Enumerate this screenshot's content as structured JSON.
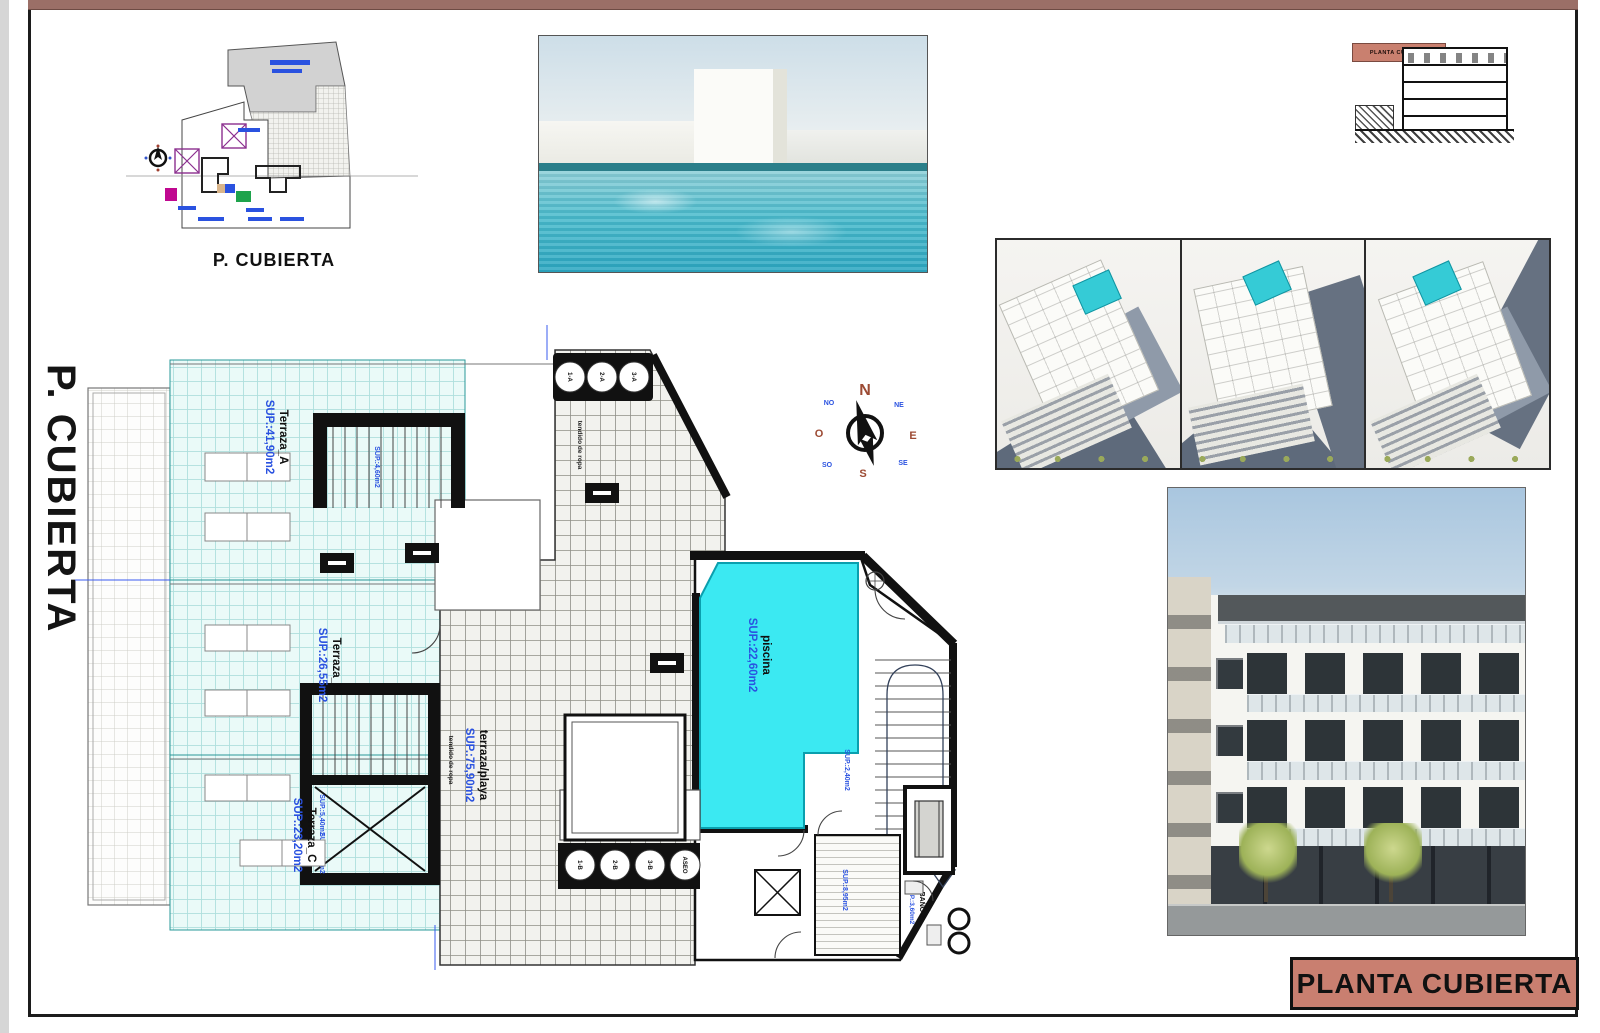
{
  "page": {
    "top_bar_color": "#9b6f67",
    "title_accent": "#c97f70"
  },
  "side_label": "P. CUBIERTA",
  "site_plan": {
    "caption": "P. CUBIERTA"
  },
  "section_thumb": {
    "label": "PLANTA CUBIERTA"
  },
  "title_block": {
    "label": "PLANTA CUBIERTA"
  },
  "compass": {
    "n": "N",
    "s": "S",
    "e": "E",
    "w": "O",
    "ne": "NE",
    "nw": "NO",
    "se": "SE",
    "sw": "SO"
  },
  "plan": {
    "rooms": [
      {
        "name": "Terraza_A",
        "area": "SUP.:41,90m2"
      },
      {
        "name": "Terraza_B",
        "area": "SUP.:26,55m2"
      },
      {
        "name": "Terraza_C",
        "area": "SUP.:23,20m2"
      },
      {
        "name": "terraza/playa",
        "area": "SUP.:75,90m2"
      },
      {
        "name": "piscina",
        "area": "SUP.:22,60m2"
      },
      {
        "name": "BAÑO-2",
        "area": "SUP.:3,60m2"
      }
    ],
    "stair_areas": [
      "SUP.:4,60m2",
      "SUP.:5,40m2",
      "SUP.:5,40m2",
      "SUP.:2,40m2",
      "SUP.:8,95m2"
    ],
    "notes": [
      "tendido de ropa",
      "tendido de ropa"
    ],
    "vents_top": [
      "1-A",
      "2-A",
      "3-A"
    ],
    "vents_bottom": [
      "1-B",
      "2-B",
      "3-B",
      "ASEO"
    ]
  }
}
